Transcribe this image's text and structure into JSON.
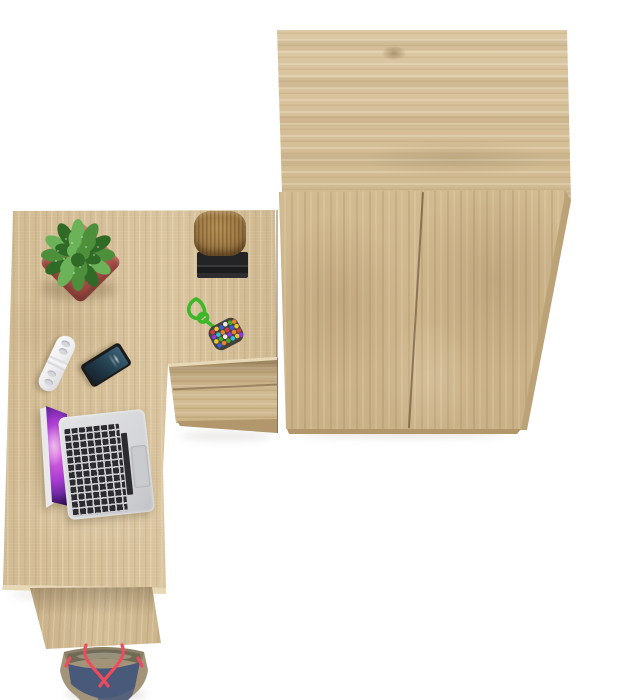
{
  "scene": {
    "description": "Top-down 3D product render of an oak (sonoma oak) L-shaped desk with a two-drawer unit, placed beside a matching two-door wardrobe on a white background",
    "view": "overhead",
    "background": "#ffffff"
  },
  "colors": {
    "bg": "#ffffff",
    "wood-base": "#d6c099",
    "wood-light2": "#dcc8a4",
    "wood-dark2": "#cdb68d",
    "wood-dark": "#b1976b",
    "edge-light": "#e7d9b6",
    "wardrobe-base": "#d2ba91",
    "pot-red": "#b2564c",
    "pot-red-dark": "#93463e",
    "leaf-green": "#4e8f3b",
    "leaf-light": "#6cb258",
    "leaf-dark": "#2f6b26",
    "cord-green": "#3db829",
    "stump-brown": "#9c7946",
    "stump-light": "#b79155",
    "base-black": "#232325",
    "laptop-silver": "#d2d3d6",
    "key-dark": "#2c2c30",
    "trackpad": "#c9cbcf",
    "screen-magenta": "#e26fe0",
    "screen-purple": "#a93bd0",
    "screen-dark": "#341055",
    "phone-body": "#1b1b1d",
    "phone-screen-a": "#3d6278",
    "phone-screen-b": "#141f29",
    "remote-white": "#ededf0",
    "bag-denim": "#49597a",
    "bag-canvas": "#a39379",
    "bag-rim": "#8d8068",
    "bag-inner": "#6e6a56",
    "bag-pocket": "#97917c",
    "bag-strap": "#ee4b5c",
    "bead-1": "#d93a3a",
    "bead-2": "#3a5fd9",
    "bead-3": "#e8c832",
    "bead-4": "#3fae2a",
    "bead-5": "#8a3ad9",
    "bead-6": "#e8842a",
    "bead-7": "#f0ece4",
    "bead-8": "#3ab8d9"
  },
  "objects": {
    "wardrobe": {
      "label": "Two-door wardrobe in oak finish, seen from above"
    },
    "desk": {
      "label": "L-shaped oak desk with two-drawer unit"
    },
    "drawer_unit": {
      "label": "Two stacked drawers under the desk return"
    },
    "leg_panel": {
      "label": "Desk end panel leg"
    },
    "plant": {
      "label": "Potted speckled green plant in red square pot"
    },
    "stump": {
      "label": "Decorative wooden log on black tray"
    },
    "keychain": {
      "label": "Green cord keychain with multicolored bead pouch"
    },
    "remote": {
      "label": "White capsule-shaped remote control"
    },
    "phone": {
      "label": "Black smartphone, screen facing up"
    },
    "laptop": {
      "label": "Open silver laptop with purple galaxy wallpaper"
    },
    "bag": {
      "label": "Denim and canvas tote bag with red straps on the floor"
    }
  }
}
